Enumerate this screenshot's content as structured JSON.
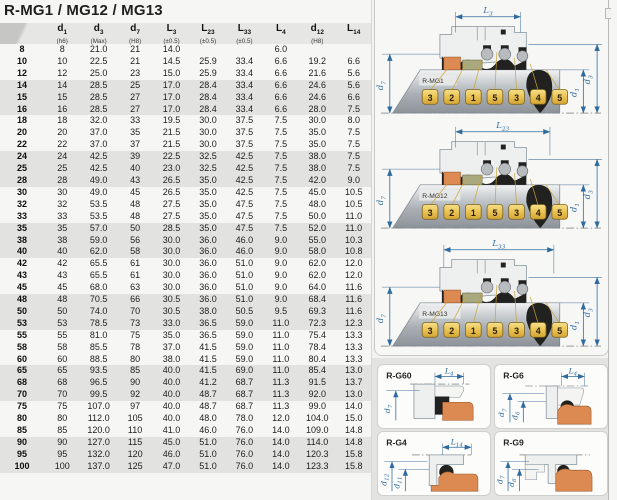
{
  "page": {
    "title": "R-MG1 / MG12 / MG13"
  },
  "colors": {
    "dimension_blue": "#2f6b9f",
    "chip_gold": "#e9c353",
    "seat_orange": "#dd8a52",
    "gasket_olive": "#a9a87e",
    "row_shade_gray": "#e2e2e0"
  },
  "table": {
    "columns": [
      {
        "base": "",
        "sub": "",
        "tol": ""
      },
      {
        "base": "d",
        "sub": "1",
        "tol": "(h6)"
      },
      {
        "base": "d",
        "sub": "3",
        "tol": "(Max)"
      },
      {
        "base": "d",
        "sub": "7",
        "tol": "(H8)"
      },
      {
        "base": "L",
        "sub": "3",
        "tol": "(±0.5)"
      },
      {
        "base": "L",
        "sub": "23",
        "tol": "(±0.5)"
      },
      {
        "base": "L",
        "sub": "33",
        "tol": "(±0.5)"
      },
      {
        "base": "L",
        "sub": "4",
        "tol": ""
      },
      {
        "base": "d",
        "sub": "12",
        "tol": "(H8)"
      },
      {
        "base": "L",
        "sub": "14",
        "tol": ""
      }
    ],
    "rows": [
      [
        "8",
        "8",
        "21.0",
        "21",
        "14.0",
        "",
        "",
        "6.0",
        "",
        ""
      ],
      [
        "10",
        "10",
        "22.5",
        "21",
        "14.5",
        "25.9",
        "33.4",
        "6.6",
        "19.2",
        "6.6"
      ],
      [
        "12",
        "12",
        "25.0",
        "23",
        "15.0",
        "25.9",
        "33.4",
        "6.6",
        "21.6",
        "5.6"
      ],
      [
        "14",
        "14",
        "28.5",
        "25",
        "17.0",
        "28.4",
        "33.4",
        "6.6",
        "24.6",
        "5.6"
      ],
      [
        "15",
        "15",
        "28.5",
        "27",
        "17.0",
        "28.4",
        "33.4",
        "6.6",
        "24.6",
        "6.6"
      ],
      [
        "16",
        "16",
        "28.5",
        "27",
        "17.0",
        "28.4",
        "33.4",
        "6.6",
        "28.0",
        "7.5"
      ],
      [
        "18",
        "18",
        "32.0",
        "33",
        "19.5",
        "30.0",
        "37.5",
        "7.5",
        "30.0",
        "8.0"
      ],
      [
        "20",
        "20",
        "37.0",
        "35",
        "21.5",
        "30.0",
        "37.5",
        "7.5",
        "35.0",
        "7.5"
      ],
      [
        "22",
        "22",
        "37.0",
        "37",
        "21.5",
        "30.0",
        "37.5",
        "7.5",
        "35.0",
        "7.5"
      ],
      [
        "24",
        "24",
        "42.5",
        "39",
        "22.5",
        "32.5",
        "42.5",
        "7.5",
        "38.0",
        "7.5"
      ],
      [
        "25",
        "25",
        "42.5",
        "40",
        "23.0",
        "32.5",
        "42.5",
        "7.5",
        "38.0",
        "7.5"
      ],
      [
        "28",
        "28",
        "49.0",
        "43",
        "26.5",
        "35.0",
        "42.5",
        "7.5",
        "42.0",
        "9.0"
      ],
      [
        "30",
        "30",
        "49.0",
        "45",
        "26.5",
        "35.0",
        "42.5",
        "7.5",
        "45.0",
        "10.5"
      ],
      [
        "32",
        "32",
        "53.5",
        "48",
        "27.5",
        "35.0",
        "47.5",
        "7.5",
        "48.0",
        "10.5"
      ],
      [
        "33",
        "33",
        "53.5",
        "48",
        "27.5",
        "35.0",
        "47.5",
        "7.5",
        "50.0",
        "11.0"
      ],
      [
        "35",
        "35",
        "57.0",
        "50",
        "28.5",
        "35.0",
        "47.5",
        "7.5",
        "52.0",
        "11.0"
      ],
      [
        "38",
        "38",
        "59.0",
        "56",
        "30.0",
        "36.0",
        "46.0",
        "9.0",
        "55.0",
        "10.3"
      ],
      [
        "40",
        "40",
        "62.0",
        "58",
        "30.0",
        "36.0",
        "46.0",
        "9.0",
        "58.0",
        "10.8"
      ],
      [
        "42",
        "42",
        "65.5",
        "61",
        "30.0",
        "36.0",
        "51.0",
        "9.0",
        "62.0",
        "12.0"
      ],
      [
        "43",
        "43",
        "65.5",
        "61",
        "30.0",
        "36.0",
        "51.0",
        "9.0",
        "62.0",
        "12.0"
      ],
      [
        "45",
        "45",
        "68.0",
        "63",
        "30.0",
        "36.0",
        "51.0",
        "9.0",
        "64.0",
        "11.6"
      ],
      [
        "48",
        "48",
        "70.5",
        "66",
        "30.5",
        "36.0",
        "51.0",
        "9.0",
        "68.4",
        "11.6"
      ],
      [
        "50",
        "50",
        "74.0",
        "70",
        "30.5",
        "38.0",
        "50.5",
        "9.5",
        "69.3",
        "11.6"
      ],
      [
        "53",
        "53",
        "78.5",
        "73",
        "33.0",
        "36.5",
        "59.0",
        "11.0",
        "72.3",
        "12.3"
      ],
      [
        "55",
        "55",
        "81.0",
        "75",
        "35.0",
        "36.5",
        "59.0",
        "11.0",
        "75.4",
        "13.3"
      ],
      [
        "58",
        "58",
        "85.5",
        "78",
        "37.0",
        "41.5",
        "59.0",
        "11.0",
        "78.4",
        "13.3"
      ],
      [
        "60",
        "60",
        "88.5",
        "80",
        "38.0",
        "41.5",
        "59.0",
        "11.0",
        "80.4",
        "13.3"
      ],
      [
        "65",
        "65",
        "93.5",
        "85",
        "40.0",
        "41.5",
        "69.0",
        "11.0",
        "85.4",
        "13.0"
      ],
      [
        "68",
        "68",
        "96.5",
        "90",
        "40.0",
        "41.2",
        "68.7",
        "11.3",
        "91.5",
        "13.7"
      ],
      [
        "70",
        "70",
        "99.5",
        "92",
        "40.0",
        "48.7",
        "68.7",
        "11.3",
        "92.0",
        "13.0"
      ],
      [
        "75",
        "75",
        "107.0",
        "97",
        "40.0",
        "48.7",
        "68.7",
        "11.3",
        "99.0",
        "14.0"
      ],
      [
        "80",
        "80",
        "112.0",
        "105",
        "40.0",
        "48.0",
        "78.0",
        "12.0",
        "104.0",
        "15.0"
      ],
      [
        "85",
        "85",
        "120.0",
        "110",
        "41.0",
        "46.0",
        "76.0",
        "14.0",
        "109.0",
        "14.8"
      ],
      [
        "90",
        "90",
        "127.0",
        "115",
        "45.0",
        "51.0",
        "76.0",
        "14.0",
        "114.0",
        "14.8"
      ],
      [
        "95",
        "95",
        "132.0",
        "120",
        "46.0",
        "51.0",
        "76.0",
        "14.0",
        "120.3",
        "15.8"
      ],
      [
        "100",
        "100",
        "137.0",
        "125",
        "47.0",
        "51.0",
        "76.0",
        "14.0",
        "123.3",
        "15.8"
      ]
    ]
  },
  "diagrams": [
    {
      "name": "R-MG1",
      "dim": {
        "base": "L",
        "sub": "3"
      },
      "left_dim": {
        "base": "d",
        "sub": "7"
      },
      "right_dims": [
        {
          "base": "d",
          "sub": "1"
        },
        {
          "base": "d",
          "sub": "3"
        }
      ],
      "callouts": [
        "3",
        "2",
        "1",
        "5",
        "3",
        "4",
        "5"
      ]
    },
    {
      "name": "R-MG12",
      "dim": {
        "base": "L",
        "sub": "23"
      },
      "left_dim": {
        "base": "d",
        "sub": "7"
      },
      "right_dims": [
        {
          "base": "d",
          "sub": "1"
        },
        {
          "base": "d",
          "sub": "3"
        }
      ],
      "callouts": [
        "3",
        "2",
        "1",
        "5",
        "3",
        "4",
        "5"
      ]
    },
    {
      "name": "R-MG13",
      "dim": {
        "base": "L",
        "sub": "33"
      },
      "left_dim": {
        "base": "d",
        "sub": "7"
      },
      "right_dims": [
        {
          "base": "d",
          "sub": "1"
        },
        {
          "base": "d",
          "sub": "3"
        }
      ],
      "callouts": [
        "3",
        "2",
        "1",
        "5",
        "3",
        "4",
        "5"
      ]
    }
  ],
  "seat_panels": [
    {
      "name": "R-G60",
      "dim": {
        "base": "L",
        "sub": "4"
      },
      "left_dims": [
        {
          "base": "d",
          "sub": "7"
        }
      ]
    },
    {
      "name": "R-G6",
      "dim": {
        "base": "L",
        "sub": "4"
      },
      "left_dims": [
        {
          "base": "d",
          "sub": "7"
        },
        {
          "base": "d",
          "sub": "6"
        }
      ]
    },
    {
      "name": "R-G4",
      "dim": {
        "base": "L",
        "sub": "14"
      },
      "left_dims": [
        {
          "base": "d",
          "sub": "12"
        },
        {
          "base": "d",
          "sub": "11"
        }
      ]
    },
    {
      "name": "R-G9",
      "dim": null,
      "left_dims": [
        {
          "base": "d",
          "sub": "7"
        },
        {
          "base": "d",
          "sub": "6"
        }
      ]
    }
  ]
}
